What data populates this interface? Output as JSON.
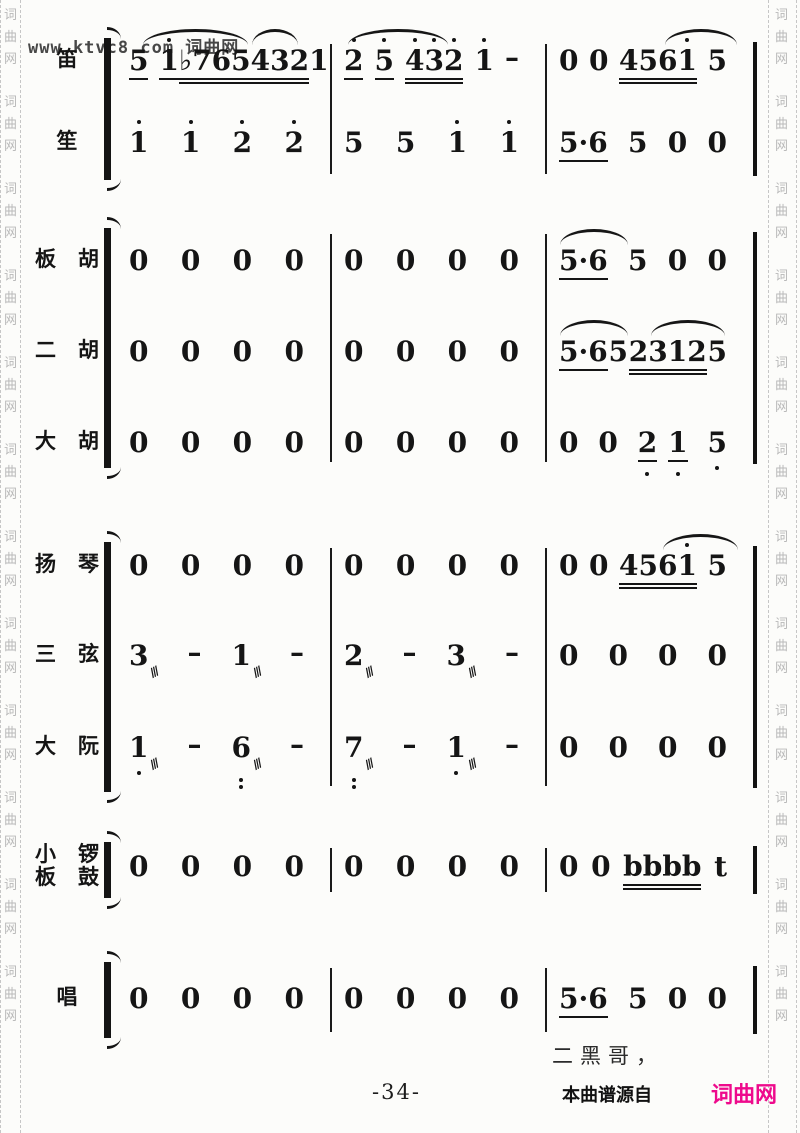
{
  "watermark": {
    "url_text": "www.ktvc8.com 词曲网",
    "side_chars": [
      "词",
      "曲",
      "网"
    ],
    "repeat": 12
  },
  "score": {
    "trem_glyph": "///",
    "geometry": {
      "measure_x": [
        115,
        330,
        545
      ],
      "measure_w": [
        215,
        215,
        208
      ],
      "barline_x": [
        330,
        545
      ],
      "end_bar_x": 753,
      "bracket_x": 104
    },
    "groups": [
      {
        "top": 38,
        "bottom": 180
      },
      {
        "top": 228,
        "bottom": 468
      },
      {
        "top": 542,
        "bottom": 792
      },
      {
        "top": 842,
        "bottom": 898
      },
      {
        "top": 962,
        "bottom": 1038
      }
    ],
    "rows": [
      {
        "name": "di",
        "label": [
          "笛"
        ],
        "y": 46,
        "measures": [
          [
            [
              {
                "g": "5",
                "ul": 1
              },
              {
                "g": "1",
                "hi": [
                  0
                ],
                "ul": 1
              }
            ],
            [
              {
                "g": "♭765",
                "ul": 2
              }
            ],
            [
              {
                "g": "432",
                "ul": 2
              }
            ],
            [
              {
                "g": "1"
              }
            ]
          ],
          [
            [
              {
                "g": "2",
                "hi": [
                  0
                ],
                "ul": 1
              }
            ],
            [
              {
                "g": "5",
                "hi": [
                  0
                ],
                "ul": 1
              }
            ],
            [
              {
                "g": "432",
                "hi": [
                  0,
                  1,
                  2
                ],
                "ul": 2
              }
            ],
            [
              {
                "g": "1",
                "hi": [
                  0
                ]
              }
            ],
            [
              {
                "g": "–"
              }
            ]
          ],
          [
            [
              {
                "g": "0"
              }
            ],
            [
              {
                "g": "0"
              }
            ],
            [
              {
                "g": "4561",
                "hi": [
                  3
                ],
                "ul": 2
              }
            ],
            [
              {
                "g": "5"
              }
            ]
          ]
        ],
        "arcs": [
          {
            "x": 143,
            "w": 105
          },
          {
            "x": 252,
            "w": 46
          },
          {
            "x": 348,
            "w": 100
          },
          {
            "x": 665,
            "w": 72
          }
        ]
      },
      {
        "name": "sheng",
        "label": [
          "笙"
        ],
        "y": 128,
        "measures": [
          [
            [
              {
                "g": "1",
                "hi": [
                  0
                ]
              }
            ],
            [
              {
                "g": "1",
                "hi": [
                  0
                ]
              }
            ],
            [
              {
                "g": "2",
                "hi": [
                  0
                ]
              }
            ],
            [
              {
                "g": "2",
                "hi": [
                  0
                ]
              }
            ]
          ],
          [
            [
              {
                "g": "5"
              }
            ],
            [
              {
                "g": "5"
              }
            ],
            [
              {
                "g": "1",
                "hi": [
                  0
                ]
              }
            ],
            [
              {
                "g": "1",
                "hi": [
                  0
                ]
              }
            ]
          ],
          [
            [
              {
                "g": "5·6",
                "ul": 1
              }
            ],
            [
              {
                "g": "5"
              }
            ],
            [
              {
                "g": "0"
              }
            ],
            [
              {
                "g": "0"
              }
            ]
          ]
        ],
        "arcs": []
      },
      {
        "name": "banhu",
        "label": [
          "板胡"
        ],
        "y": 246,
        "measures": [
          "0000",
          "0000",
          [
            [
              {
                "g": "5·6",
                "ul": 1
              }
            ],
            [
              {
                "g": "5"
              }
            ],
            [
              {
                "g": "0"
              }
            ],
            [
              {
                "g": "0"
              }
            ]
          ]
        ],
        "arcs": [
          {
            "x": 560,
            "w": 68
          }
        ]
      },
      {
        "name": "erhu",
        "label": [
          "二胡"
        ],
        "y": 337,
        "measures": [
          "0000",
          "0000",
          [
            [
              {
                "g": "5·6",
                "ul": 1
              }
            ],
            [
              {
                "g": "5"
              }
            ],
            [
              {
                "g": "2312",
                "ul": 2
              }
            ],
            [
              {
                "g": "5"
              }
            ]
          ]
        ],
        "arcs": [
          {
            "x": 560,
            "w": 68
          },
          {
            "x": 651,
            "w": 74
          }
        ]
      },
      {
        "name": "dahu",
        "label": [
          "大胡"
        ],
        "y": 428,
        "measures": [
          "0000",
          "0000",
          [
            [
              {
                "g": "0"
              }
            ],
            [
              {
                "g": "0"
              }
            ],
            [
              {
                "g": "2",
                "lo": [
                  0
                ],
                "ul": 1
              },
              {
                "g": "1",
                "lo": [
                  0
                ],
                "ul": 1
              }
            ],
            [
              {
                "g": "5",
                "lo": [
                  0
                ]
              }
            ]
          ]
        ],
        "arcs": []
      },
      {
        "name": "yangqin",
        "label": [
          "扬琴"
        ],
        "y": 551,
        "measures": [
          "0000",
          "0000",
          [
            [
              {
                "g": "0"
              }
            ],
            [
              {
                "g": "0"
              }
            ],
            [
              {
                "g": "4561",
                "hi": [
                  3
                ],
                "ul": 2
              }
            ],
            [
              {
                "g": "5"
              }
            ]
          ]
        ],
        "arcs": [
          {
            "x": 663,
            "w": 75
          }
        ]
      },
      {
        "name": "sanxian",
        "label": [
          "三弦"
        ],
        "y": 641,
        "measures": [
          [
            [
              {
                "g": "3",
                "trem": true
              }
            ],
            [
              {
                "g": "–"
              }
            ],
            [
              {
                "g": "1",
                "trem": true
              }
            ],
            [
              {
                "g": "–"
              }
            ]
          ],
          [
            [
              {
                "g": "2",
                "trem": true
              }
            ],
            [
              {
                "g": "–"
              }
            ],
            [
              {
                "g": "3",
                "trem": true
              }
            ],
            [
              {
                "g": "–"
              }
            ]
          ],
          "0000"
        ],
        "arcs": []
      },
      {
        "name": "daruan",
        "label": [
          "大阮"
        ],
        "y": 733,
        "measures": [
          [
            [
              {
                "g": "1",
                "lo": [
                  0
                ],
                "trem": true
              }
            ],
            [
              {
                "g": "–"
              }
            ],
            [
              {
                "g": "6",
                "lo2": [
                  0
                ],
                "trem": true
              }
            ],
            [
              {
                "g": "–"
              }
            ]
          ],
          [
            [
              {
                "g": "7",
                "lo2": [
                  0
                ],
                "trem": true
              }
            ],
            [
              {
                "g": "–"
              }
            ],
            [
              {
                "g": "1",
                "lo": [
                  0
                ],
                "trem": true
              }
            ],
            [
              {
                "g": "–"
              }
            ]
          ],
          "0000"
        ],
        "arcs": []
      },
      {
        "name": "percussion",
        "label": [
          "小锣",
          "板鼓"
        ],
        "y": 852,
        "measures": [
          "0000",
          "0000",
          [
            [
              {
                "g": "0"
              }
            ],
            [
              {
                "g": "0"
              }
            ],
            [
              {
                "g": "bbbb",
                "ul": 2
              }
            ],
            [
              {
                "g": "t"
              }
            ]
          ]
        ],
        "arcs": []
      },
      {
        "name": "chang",
        "label": [
          "唱"
        ],
        "y": 984,
        "measures": [
          "0000",
          "0000",
          [
            [
              {
                "g": "5·6",
                "ul": 1
              }
            ],
            [
              {
                "g": "5"
              }
            ],
            [
              {
                "g": "0"
              }
            ],
            [
              {
                "g": "0"
              }
            ]
          ]
        ],
        "arcs": []
      }
    ]
  },
  "footer": {
    "lyric": "二黑哥，",
    "page_number": "-34-",
    "source_note": "本曲谱源自",
    "brand": "词曲网",
    "brand_color": "#ee0a8c"
  }
}
